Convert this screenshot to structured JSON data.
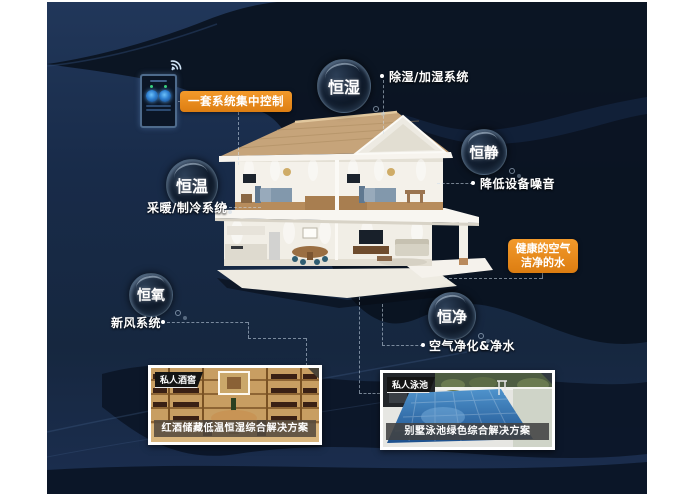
{
  "poster": {
    "theme": "smart-home five-constants system infographic"
  },
  "colors": {
    "background_navy": "#172a47",
    "dark_band": "#0a1220",
    "accent_orange": "#e8891c",
    "text": "#ffffff"
  },
  "control_panel": {
    "device": "wall-mounted smart control panel",
    "wifi_icon": "wifi-signal",
    "label": "一套系统集中控制"
  },
  "bubbles": [
    {
      "id": "constant-humidity",
      "label": "恒湿",
      "feature": "除湿/加湿系统"
    },
    {
      "id": "constant-quiet",
      "label": "恒静",
      "feature": "降低设备噪音"
    },
    {
      "id": "constant-temperature",
      "label": "恒温",
      "feature": "采暖/制冷系统"
    },
    {
      "id": "constant-oxygen",
      "label": "恒氧",
      "feature": "新风系统"
    },
    {
      "id": "constant-purity",
      "label": "恒净",
      "feature": "空气净化&净水"
    }
  ],
  "highlight_box": {
    "line1": "健康的空气",
    "line2": "洁净的水"
  },
  "cards": [
    {
      "id": "wine-cellar",
      "tag": "私人酒窖",
      "caption": "红酒储藏低温恒湿综合解决方案"
    },
    {
      "id": "pool",
      "tag": "私人泳池",
      "caption": "别墅泳池绿色综合解决方案"
    }
  ]
}
